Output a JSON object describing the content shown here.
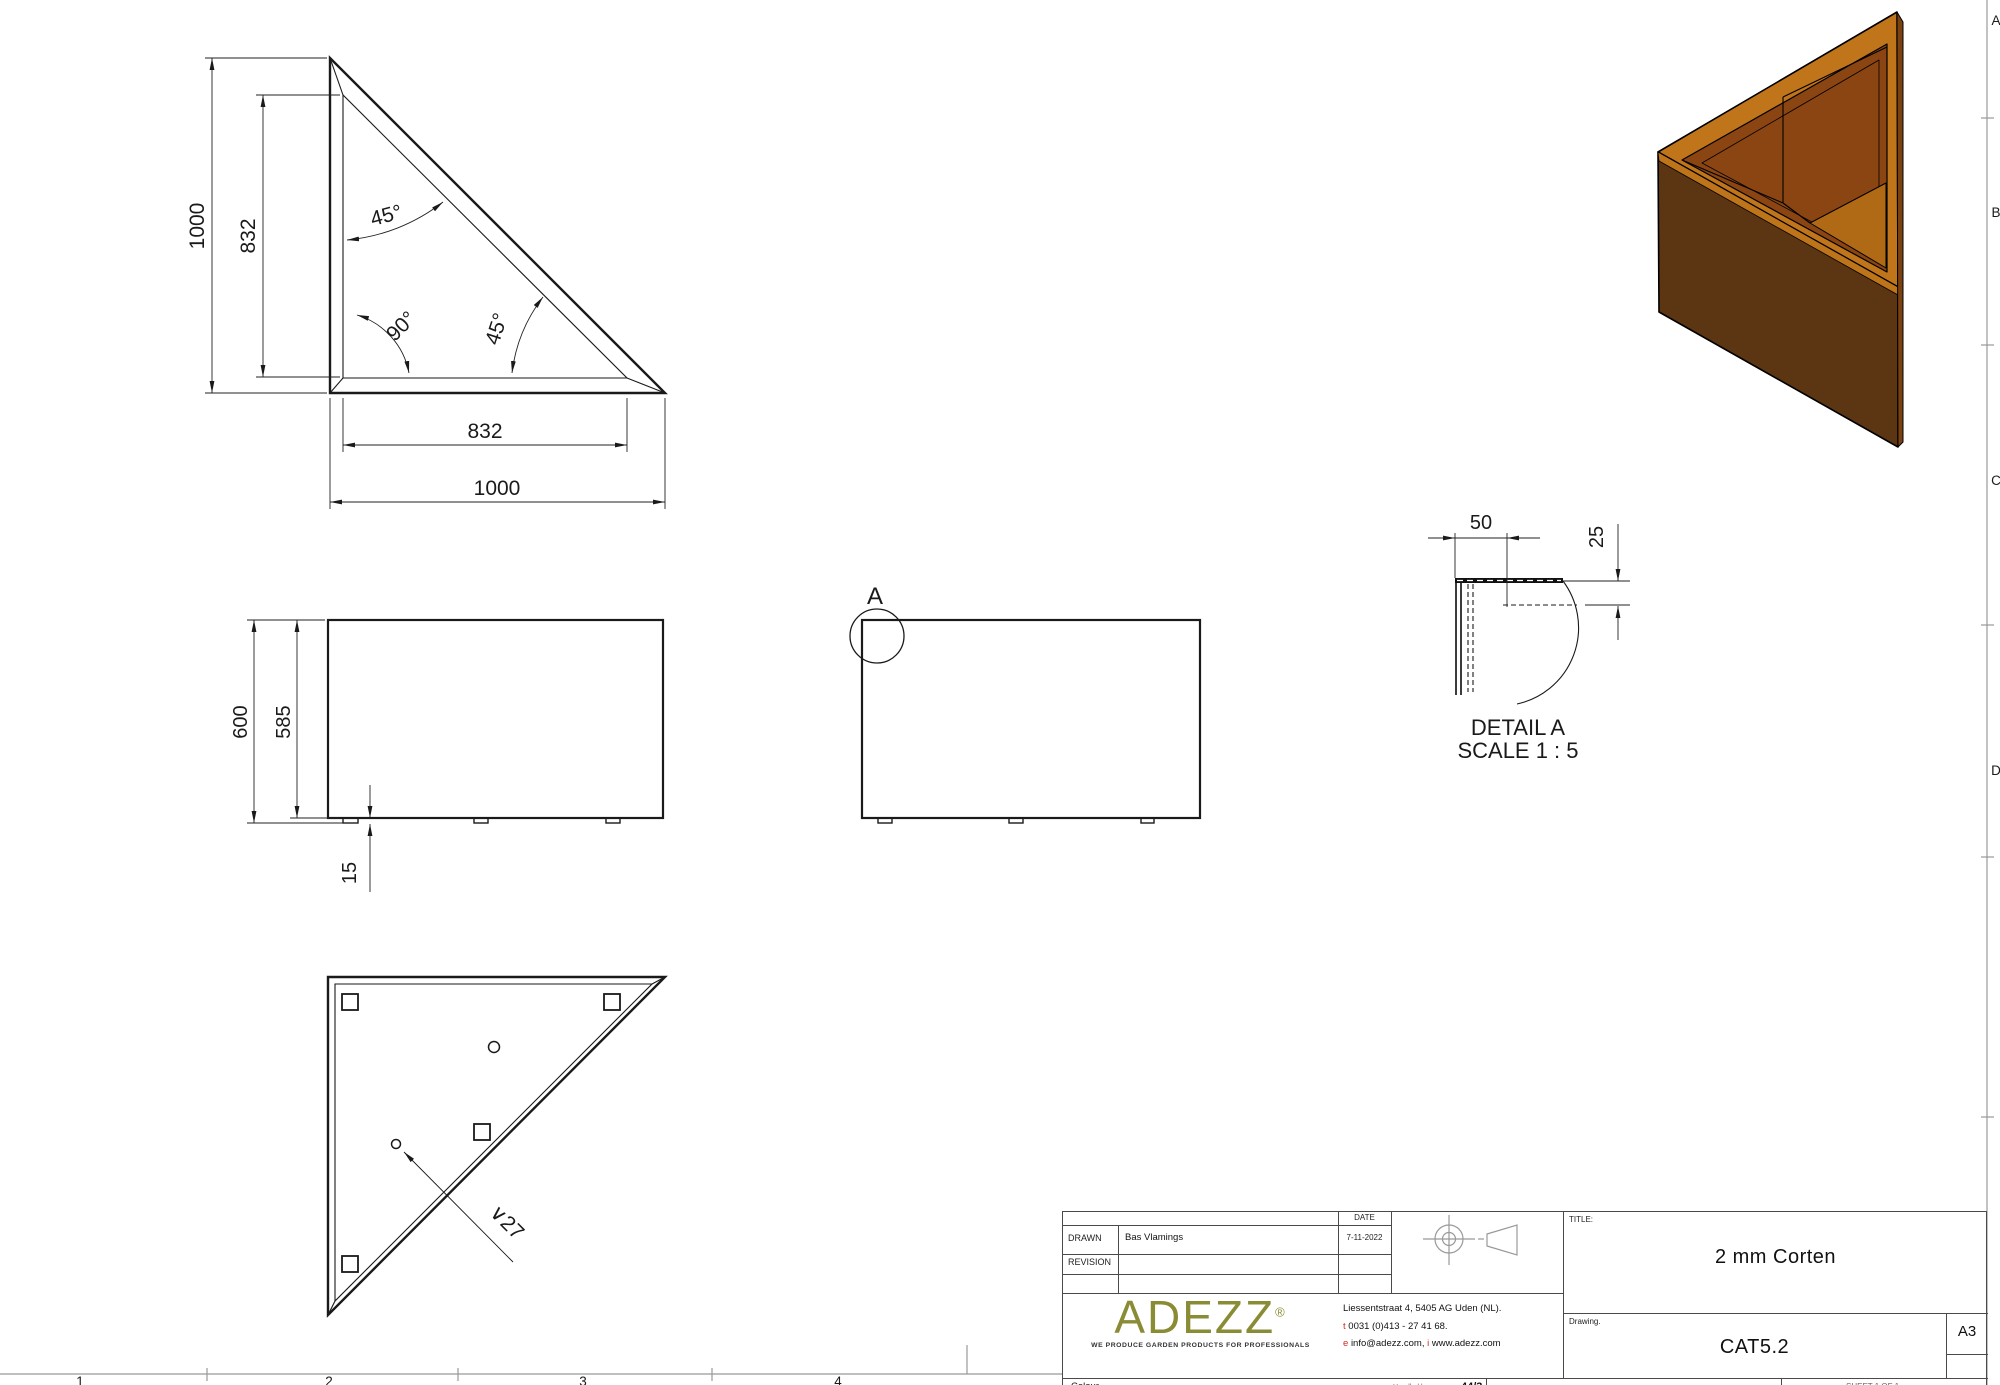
{
  "sheet": {
    "paper_size": "A3",
    "zone_columns": [
      "1",
      "2",
      "3",
      "4"
    ],
    "zone_rows": [
      "A",
      "B",
      "C",
      "D"
    ]
  },
  "views": {
    "top": {
      "dim_left_outer": "1000",
      "dim_left_inner": "832",
      "dim_bottom_inner": "832",
      "dim_bottom_outer": "1000",
      "angle_top": "45°",
      "angle_corner": "90°",
      "angle_hypotenuse": "45°"
    },
    "front": {
      "dim_height_outer": "600",
      "dim_height_inner": "585",
      "dim_foot_height": "15"
    },
    "side": {
      "detail_marker": "A"
    },
    "detail": {
      "title": "DETAIL A",
      "scale": "SCALE 1 : 5",
      "dim_flange_width": "50",
      "dim_flange_drop": "25"
    },
    "bottom": {
      "hole_diameter": "∨27"
    }
  },
  "title_block": {
    "date_label": "DATE",
    "date_value": "7-11-2022",
    "drawn_label": "DRAWN",
    "drawn_value": "Bas Vlamings",
    "revision_label": "REVISION",
    "title_label": "TITLE:",
    "title_value": "2 mm Corten",
    "drawing_label": "Drawing.",
    "drawing_value": "CAT5.2",
    "paper_size": "A3",
    "company": {
      "logo": "ADEZZ",
      "registered": "®",
      "tagline": "WE PRODUCE GARDEN PRODUCTS FOR PROFESSIONALS",
      "address": "Liessentstraat 4, 5405 AG Uden (NL).",
      "phone_prefix": "t",
      "phone": "0031 (0)413 - 27 41 68.",
      "email_prefix": "e",
      "email": "info@adezz.com,",
      "web_prefix": "i",
      "web": "www.adezz.com"
    },
    "bottom_row": {
      "colour_label": "Colour",
      "handled_label": "Handled by",
      "handled_value": "44/3",
      "sheet_label": "SHEET 1 OF 1"
    }
  },
  "colors": {
    "corten_rim": "#C0751B",
    "corten_front": "#5C3513",
    "corten_inner": "#8A4513",
    "corten_floor": "#B06A15",
    "corten_edge": "#7A4210",
    "corten_strip": "#BE7419",
    "logo_olive": "#8A8B35",
    "accent_red": "#D42A20",
    "line": "#1A1A1A",
    "frame": "#999999"
  }
}
